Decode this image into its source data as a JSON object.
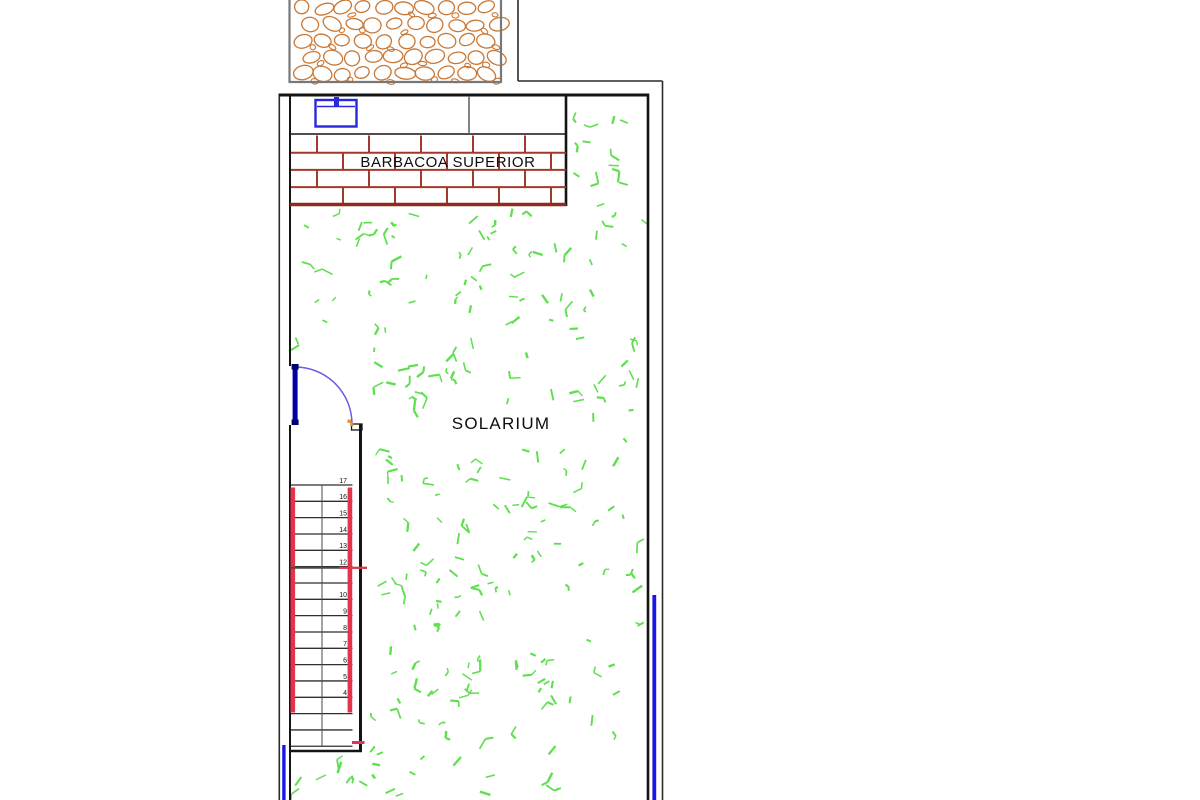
{
  "page": {
    "background": "#ffffff",
    "description": "CAD roof-terrace floor plan"
  },
  "labels": {
    "barbacoa_superior": "BARBACOA SUPERIOR",
    "solarium": "SOLARIUM"
  },
  "stairs": {
    "step_labels": [
      "17",
      "16",
      "15",
      "14",
      "13",
      "12",
      "",
      "10",
      "9",
      "8",
      "7",
      "6",
      "5",
      "4",
      "",
      "",
      ""
    ]
  },
  "colors": {
    "wall": "#141414",
    "outer_line": "#2a2a2a",
    "cobblestone": "#c97734",
    "cobble_border": "#787878",
    "brick_mortar": "#a5382c",
    "brick_bottom": "#8e2b20",
    "stair_stringer": "#e4344b",
    "stair_line": "#2f2f2f",
    "stair_divider": "#4a4a4a",
    "door_leaf": "#0000a2",
    "door_cap": "#00006e",
    "door_arc": "#6a5fe0",
    "door_marker": "#d79433",
    "sink": "#2828dd",
    "edge_blue": "#1717e8",
    "grass": "#5fdf4f",
    "divider_gray": "#666666"
  }
}
